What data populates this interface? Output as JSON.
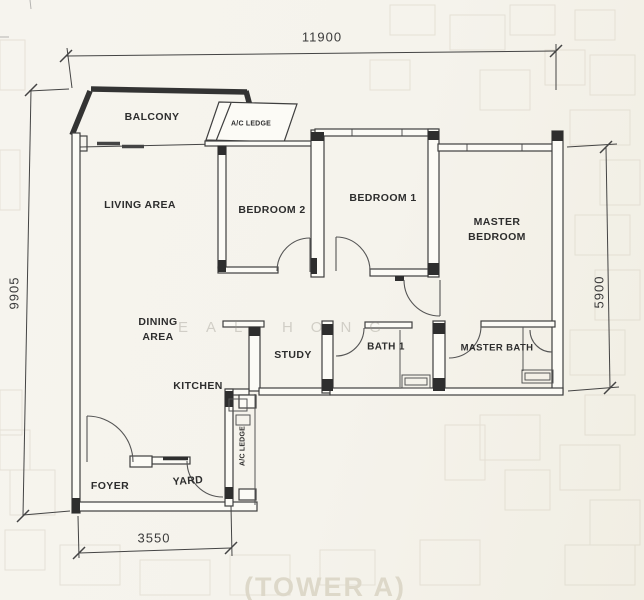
{
  "labels": {
    "balcony": "BALCONY",
    "ac_ledge_top": "A/C LEDGE",
    "living_area": "LIVING  AREA",
    "bedroom2": "BEDROOM 2",
    "bedroom1": "BEDROOM 1",
    "master_bedroom_line1": "MASTER",
    "master_bedroom_line2": "BEDROOM",
    "dining_line1": "DINING",
    "dining_line2": "AREA",
    "study": "STUDY",
    "bath1": "BATH 1",
    "master_bath": "MASTER BATH",
    "kitchen": "KITCHEN",
    "ac_ledge_side": "A/C LEDGE",
    "foyer": "FOYER",
    "yard": "YARD"
  },
  "dimensions": {
    "top_width": "11900",
    "left_height": "9905",
    "right_height": "5900",
    "bottom_width": "3550"
  },
  "watermark": "EAL HONG",
  "footer_text": "(TOWER A)",
  "colors": {
    "paper": "#f5f3ec",
    "wall_line": "#3f3f3f",
    "column_fill": "#2e2e2e",
    "label_text": "#2d2d2d",
    "ghost_line": "#d8d2c4"
  }
}
